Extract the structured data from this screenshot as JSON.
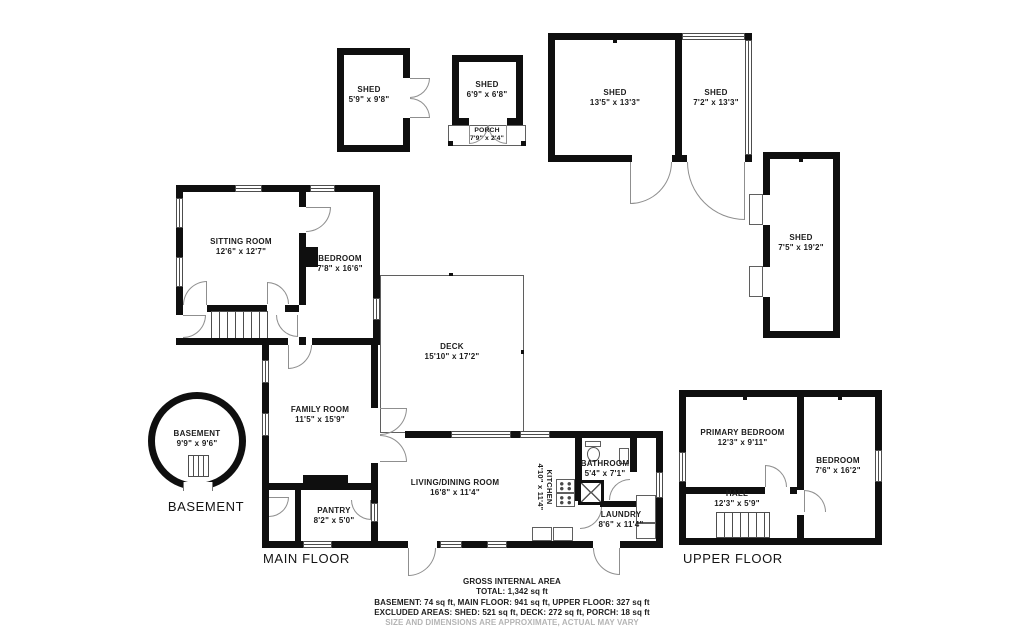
{
  "title": "Residential floor plan",
  "areas": {
    "shed_a": {
      "name": "SHED",
      "dims": "5'9\" x 9'8\""
    },
    "shed_b": {
      "name": "SHED",
      "dims": "6'9\" x 6'8\""
    },
    "porch": {
      "name": "PORCH",
      "dims": "7'9\" x 2'4\""
    },
    "shed_c": {
      "name": "SHED",
      "dims": "13'5\" x 13'3\""
    },
    "shed_d": {
      "name": "SHED",
      "dims": "7'2\" x 13'3\""
    },
    "shed_e": {
      "name": "SHED",
      "dims": "7'5\" x 19'2\""
    },
    "sitting_room": {
      "name": "SITTING ROOM",
      "dims": "12'6\" x 12'7\""
    },
    "bedroom_main": {
      "name": "BEDROOM",
      "dims": "7'8\" x 16'6\""
    },
    "deck": {
      "name": "DECK",
      "dims": "15'10\" x 17'2\""
    },
    "family_room": {
      "name": "FAMILY ROOM",
      "dims": "11'5\" x 15'9\""
    },
    "living_dining": {
      "name": "LIVING/DINING ROOM",
      "dims": "16'8\" x 11'4\""
    },
    "kitchen": {
      "name": "KITCHEN",
      "dims": "4'10\" x 11'4\""
    },
    "bathroom": {
      "name": "BATHROOM",
      "dims": "5'4\" x 7'1\""
    },
    "laundry": {
      "name": "LAUNDRY",
      "dims": "8'6\" x 11'4\""
    },
    "pantry": {
      "name": "PANTRY",
      "dims": "8'2\" x 5'0\""
    },
    "basement_room": {
      "name": "BASEMENT",
      "dims": "9'9\" x 9'6\""
    },
    "primary_bedroom": {
      "name": "PRIMARY BEDROOM",
      "dims": "12'3\" x 9'11\""
    },
    "bedroom_upper": {
      "name": "BEDROOM",
      "dims": "7'6\" x 16'2\""
    },
    "hall": {
      "name": "HALL",
      "dims": "12'3\" x 5'9\""
    }
  },
  "floor_labels": {
    "basement": "BASEMENT",
    "main": "MAIN FLOOR",
    "upper": "UPPER FLOOR"
  },
  "footer": {
    "line1": "GROSS INTERNAL AREA",
    "line2": "TOTAL: 1,342 sq ft",
    "line3": "BASEMENT: 74 sq ft, MAIN FLOOR: 941 sq ft, UPPER FLOOR: 327 sq ft",
    "line4": "EXCLUDED AREAS: SHED: 521 sq ft, DECK: 272 sq ft, PORCH: 18 sq ft",
    "line5": "SIZE AND DIMENSIONS ARE APPROXIMATE, ACTUAL MAY VARY"
  },
  "colors": {
    "wall": "#0f0f0f",
    "thin_line": "#4d4d4d",
    "door_arc": "#8f8f8f",
    "text": "#1c1c1c",
    "disclaimer": "#b4b4b4",
    "background": "#ffffff"
  }
}
